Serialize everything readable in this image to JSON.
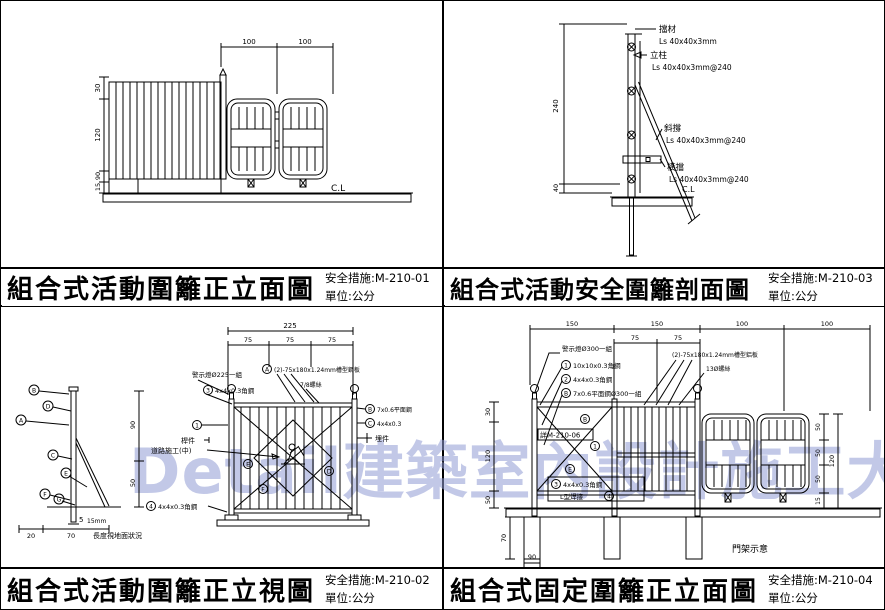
{
  "watermark": "Detail建築室內設計施工大樣圖庫",
  "tl": {
    "title": "組合式活動圍籬正立面圖",
    "code": "安全措施:M-210-01",
    "unit": "單位:公分",
    "dims": {
      "top1": "100",
      "top2": "100",
      "h1": "30",
      "h2": "120",
      "h3": "90",
      "h4": "15"
    },
    "cl": "C.L"
  },
  "tr": {
    "title": "組合式活動安全圍籬剖面圖",
    "code": "安全措施:M-210-03",
    "unit": "單位:公分",
    "dims": {
      "v1": "240",
      "v2": "40"
    },
    "cl": "C.L",
    "ann": {
      "cap": "擋材",
      "cap_spec": "Ls 40x40x3mm",
      "post": "立柱",
      "post_spec": "Ls 40x40x3mm@240",
      "brace": "斜撐",
      "brace_spec": "Ls 40x40x3mm@240",
      "rail": "橫擋",
      "rail_spec": "Ls 40x40x3mm@240"
    }
  },
  "bl": {
    "title": "組合式活動圍籬正立視圖",
    "code": "安全措施:M-210-02",
    "unit": "單位:公分",
    "dims": {
      "total": "225",
      "s1": "75",
      "s2": "75",
      "s3": "75",
      "sv1": "90",
      "sv2": "50",
      "sb1": "20",
      "sb2": "70",
      "sb3": "5",
      "sb4": "15mm"
    },
    "note": "長度視地面狀況",
    "ann": {
      "warn": "警示燈Ø225一組",
      "angle3": "4x4x0.3角鋼",
      "plate": "(2)-75x180x1.24mm槽型鋼板",
      "screw": "7/8螺絲",
      "member": "桿件",
      "sign": "道路施工(中)",
      "flat": "7x0.6平面鋼",
      "angleC": "4x4x0.3",
      "embed": "埋件",
      "angle4": "4x4x0.3角鋼"
    },
    "marks": {
      "m1": "1",
      "m3": "3",
      "m4": "4",
      "mA": "A",
      "mB": "B",
      "mC": "C",
      "s1": "B",
      "s2": "D",
      "s3": "A",
      "s4": "C",
      "s5": "E",
      "s6": "F",
      "s7": "G",
      "p1": "E",
      "p2": "D",
      "p3": "F"
    }
  },
  "br": {
    "title": "組合式固定圍籬正立面圖",
    "code": "安全措施:M-210-04",
    "unit": "單位:公分",
    "dims": {
      "t1": "150",
      "t2": "150",
      "t3": "100",
      "t4": "100",
      "s1": "75",
      "s2": "75",
      "l1": "30",
      "l2": "120",
      "l3": "50",
      "l4": "70",
      "b1": "90",
      "r1": "50",
      "r2": "50",
      "r3": "50",
      "r4": "120",
      "r5": "15"
    },
    "ann": {
      "warn": "警示燈Ø300一組",
      "angle1": "10x10x0.3角鋼",
      "angle2": "4x4x0.3角鋼",
      "flat": "7x0.6平面鋼Ø300一組",
      "plate": "(2)-75x180x1.24mm槽型鋁板",
      "screw": "13Ø螺絲",
      "ref": "詳M-210-06",
      "angle3": "4x4x0.3角鋼",
      "weld": "L型焊接",
      "gate": "門架示意"
    },
    "marks": {
      "m1": "1",
      "m2": "2",
      "m3": "3",
      "m4": "4",
      "mB": "B",
      "p1": "B",
      "p2": "1",
      "p3": "E"
    }
  }
}
